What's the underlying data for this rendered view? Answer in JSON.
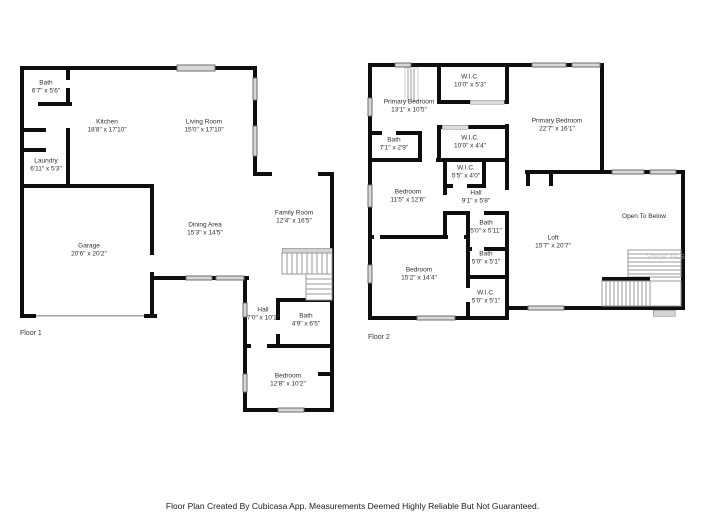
{
  "caption": "Floor Plan Created By Cubicasa App. Measurements Deemed Highly Reliable But Not Guaranteed.",
  "watermark": "Stellar MLS",
  "colors": {
    "wall": "#0e0e0e",
    "window": "#d8d8d8",
    "stair": "#9a9a9a",
    "label_text": "#2e2e2e"
  },
  "floor1": {
    "label": "Floor 1",
    "rooms": [
      {
        "name": "Bath",
        "dims": "6'7\" x 5'6\""
      },
      {
        "name": "Kitchen",
        "dims": "18'8\" x 17'10\""
      },
      {
        "name": "Living Room",
        "dims": "15'0\" x 17'10\""
      },
      {
        "name": "Laundry",
        "dims": "6'11\" x 5'3\""
      },
      {
        "name": "Garage",
        "dims": "20'6\" x 20'2\""
      },
      {
        "name": "Dining Area",
        "dims": "15'3\" x 14'5\""
      },
      {
        "name": "Family Room",
        "dims": "12'4\" x 16'5\""
      },
      {
        "name": "Hall",
        "dims": "7'0\" x 10'1\""
      },
      {
        "name": "Bath",
        "dims": "4'9\" x 6'5\""
      },
      {
        "name": "Bedroom",
        "dims": "12'8\" x 10'2\""
      }
    ]
  },
  "floor2": {
    "label": "Floor 2",
    "rooms": [
      {
        "name": "Primary Bedroom",
        "dims": "13'1\" x 10'5\""
      },
      {
        "name": "W.I.C.",
        "dims": "10'0\" x 5'3\""
      },
      {
        "name": "Primary Bedroom",
        "dims": "22'7\" x 16'1\""
      },
      {
        "name": "Bath",
        "dims": "7'1\" x 2'9\""
      },
      {
        "name": "W.I.C.",
        "dims": "10'0\" x 4'4\""
      },
      {
        "name": "W.I.C.",
        "dims": "5'5\" x 4'0\""
      },
      {
        "name": "Bedroom",
        "dims": "11'5\" x 12'6\""
      },
      {
        "name": "Hall",
        "dims": "9'1\" x 5'8\""
      },
      {
        "name": "Bath",
        "dims": "5'0\" x 5'11\""
      },
      {
        "name": "Bath",
        "dims": "5'0\" x 5'1\""
      },
      {
        "name": "Bedroom",
        "dims": "15'2\" x 14'4\""
      },
      {
        "name": "W.I.C.",
        "dims": "5'0\" x 5'1\""
      },
      {
        "name": "Loft",
        "dims": "15'7\" x 20'7\""
      },
      {
        "name": "Open To Below",
        "dims": ""
      }
    ]
  }
}
